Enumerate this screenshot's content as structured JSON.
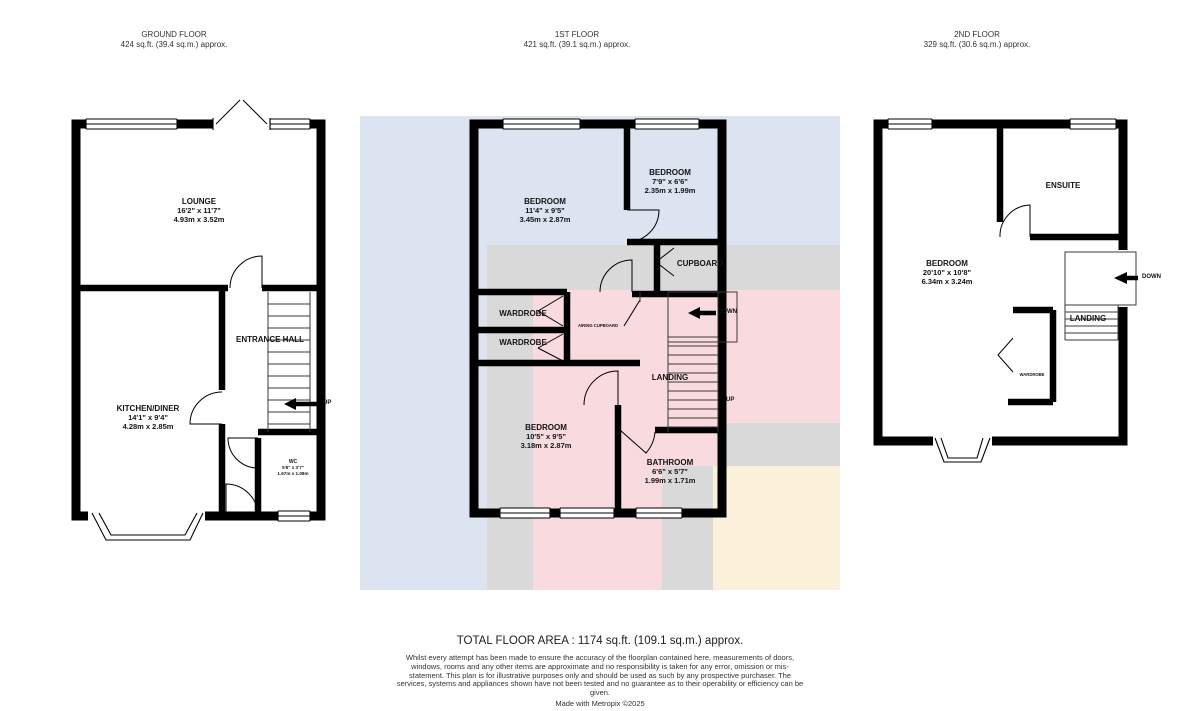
{
  "floors": [
    {
      "title": "GROUND FLOOR",
      "area": "424 sq.ft. (39.4 sq.m.) approx.",
      "rooms": [
        {
          "name": "LOUNGE",
          "imperial": "16'2\" x 11'7\"",
          "metric": "4.93m x 3.52m"
        },
        {
          "name": "KITCHEN/DINER",
          "imperial": "14'1\" x 9'4\"",
          "metric": "4.28m x 2.85m"
        },
        {
          "name": "ENTRANCE HALL"
        },
        {
          "name": "WC",
          "imperial": "5'6\" x 3'7\"",
          "metric": "1.67m x 1.08m"
        }
      ],
      "labels": {
        "up": "UP"
      }
    },
    {
      "title": "1ST FLOOR",
      "area": "421 sq.ft. (39.1 sq.m.) approx.",
      "rooms": [
        {
          "name": "BEDROOM",
          "imperial": "11'4\" x 9'5\"",
          "metric": "3.45m x 2.87m"
        },
        {
          "name": "BEDROOM",
          "imperial": "7'9\" x 6'6\"",
          "metric": "2.35m x 1.99m"
        },
        {
          "name": "CUPBOARD"
        },
        {
          "name": "WARDROBE"
        },
        {
          "name": "WARDROBE"
        },
        {
          "name": "AIRING CUPBOARD"
        },
        {
          "name": "LANDING"
        },
        {
          "name": "BEDROOM",
          "imperial": "10'5\" x 9'5\"",
          "metric": "3.18m x 2.87m"
        },
        {
          "name": "BATHROOM",
          "imperial": "6'6\" x 5'7\"",
          "metric": "1.99m x 1.71m"
        }
      ],
      "labels": {
        "up": "UP",
        "down": "DOWN"
      }
    },
    {
      "title": "2ND FLOOR",
      "area": "329 sq.ft. (30.6 sq.m.) approx.",
      "rooms": [
        {
          "name": "ENSUITE"
        },
        {
          "name": "BEDROOM",
          "imperial": "20'10\" x 10'8\"",
          "metric": "6.34m x 3.24m"
        },
        {
          "name": "LANDING"
        },
        {
          "name": "WARDROBE"
        }
      ],
      "labels": {
        "down": "DOWN"
      }
    }
  ],
  "footer": {
    "total": "TOTAL FLOOR AREA : 1174 sq.ft. (109.1 sq.m.) approx.",
    "disclaimer": "Whilst every attempt has been made to ensure the accuracy of the floorplan contained here, measurements of doors, windows, rooms and any other items are approximate and no responsibility is taken for any error, omission or mis-statement. This plan is for illustrative purposes only and should be used as such by any prospective purchaser. The services, systems and appliances shown have not been tested and no guarantee as to their operability or efficiency can be given.",
    "credit": "Made with Metropix ©2025"
  },
  "colors": {
    "wall": "#000000",
    "underlay_blue": "#dbe4f0",
    "underlay_gray": "#d9d9d9",
    "underlay_pink": "#f9dade",
    "underlay_cream": "#fbf1da"
  }
}
